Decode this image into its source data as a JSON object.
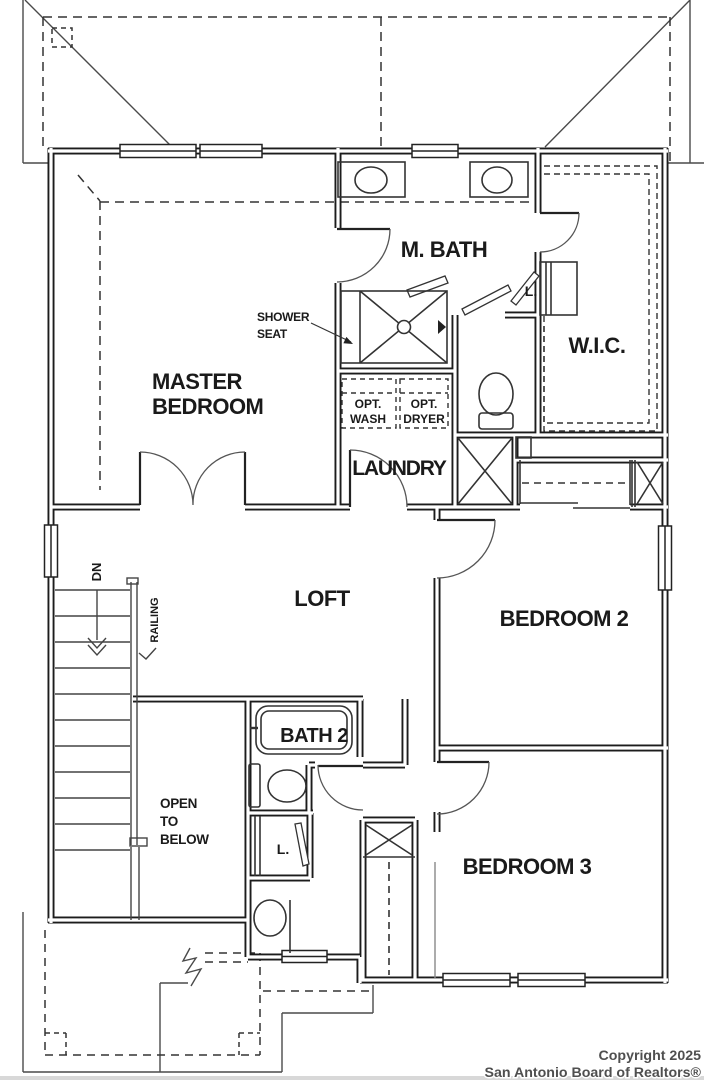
{
  "meta": {
    "background_color": "#ffffff",
    "line_color": "#1c1c1c",
    "thin_line_color": "#3a3a3a",
    "footer_bar_color": "#d8d8d8",
    "copyright_text_color": "#4f4f4f"
  },
  "plan": {
    "rooms": {
      "master_bedroom_line1": "MASTER",
      "master_bedroom_line2": "BEDROOM",
      "m_bath": "M. BATH",
      "wic": "W.I.C.",
      "laundry": "LAUNDRY",
      "loft": "LOFT",
      "bedroom2": "BEDROOM 2",
      "bath2": "BATH 2",
      "open_to_below": [
        "OPEN",
        "TO",
        "BELOW"
      ],
      "bedroom3": "BEDROOM 3"
    },
    "annotations": {
      "shower_seat": [
        "SHOWER",
        "SEAT"
      ],
      "opt_wash": [
        "OPT.",
        "WASH"
      ],
      "opt_dryer": [
        "OPT.",
        "DRYER"
      ],
      "linen_mbath": "L.",
      "linen_bath2": "L.",
      "stairs_direction": "DN",
      "railing": "RAILING"
    }
  },
  "footer": {
    "copyright_line1": "Copyright 2025",
    "copyright_line2": "San Antonio Board of Realtors®"
  }
}
